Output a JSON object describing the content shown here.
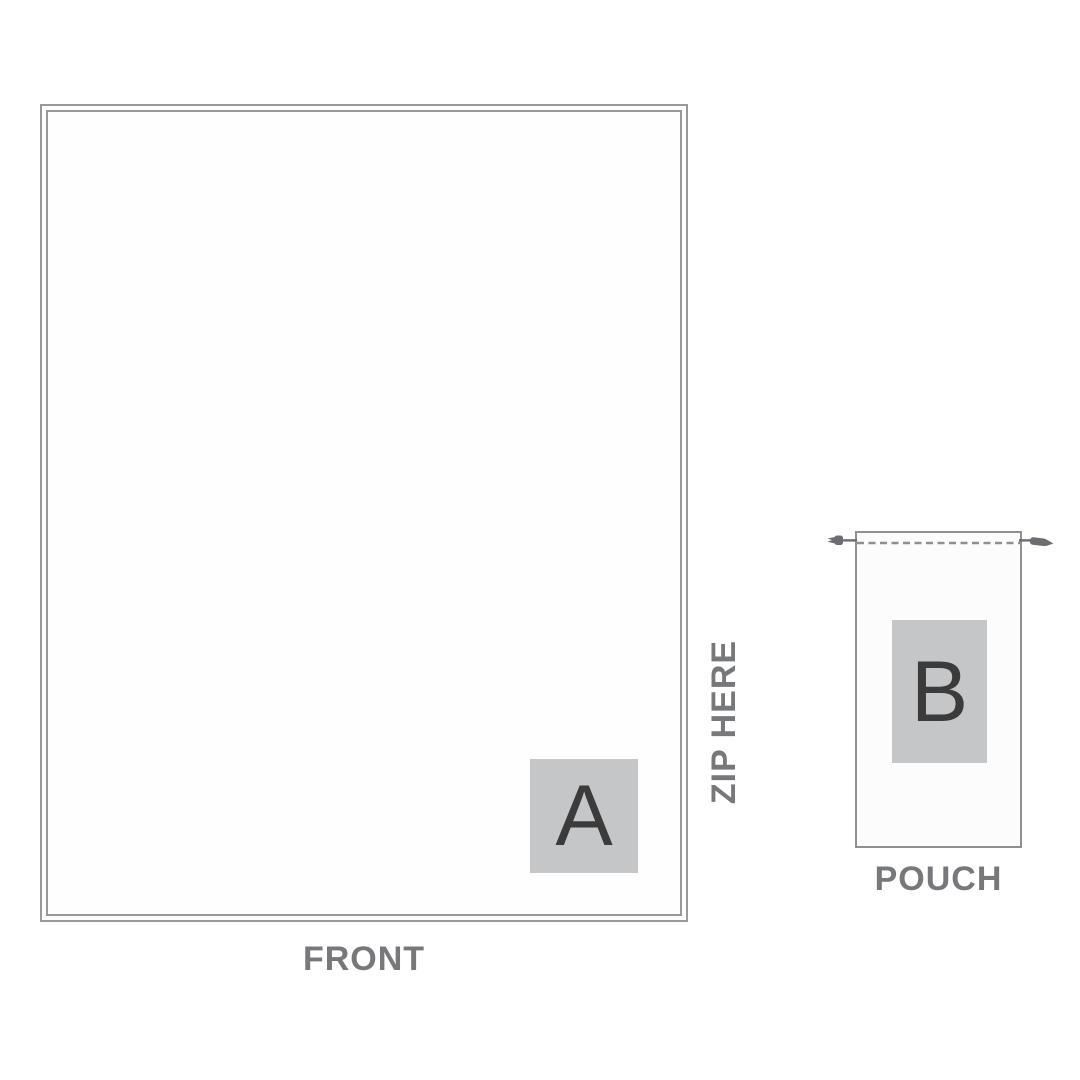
{
  "diagram": {
    "title": "apparel print template",
    "front_panel": {
      "label": "FRONT",
      "zip_label": "ZIP HERE",
      "marker": "A"
    },
    "pouch": {
      "label": "POUCH",
      "marker": "B"
    }
  },
  "colors": {
    "background": "#ffffff",
    "outline": "#97999c",
    "pouch_outline": "#8e9093",
    "label_text": "#77787b",
    "marker_background": "#c5c6c8",
    "marker_text": "#3b3b3c",
    "cord": "#6b6d70"
  }
}
